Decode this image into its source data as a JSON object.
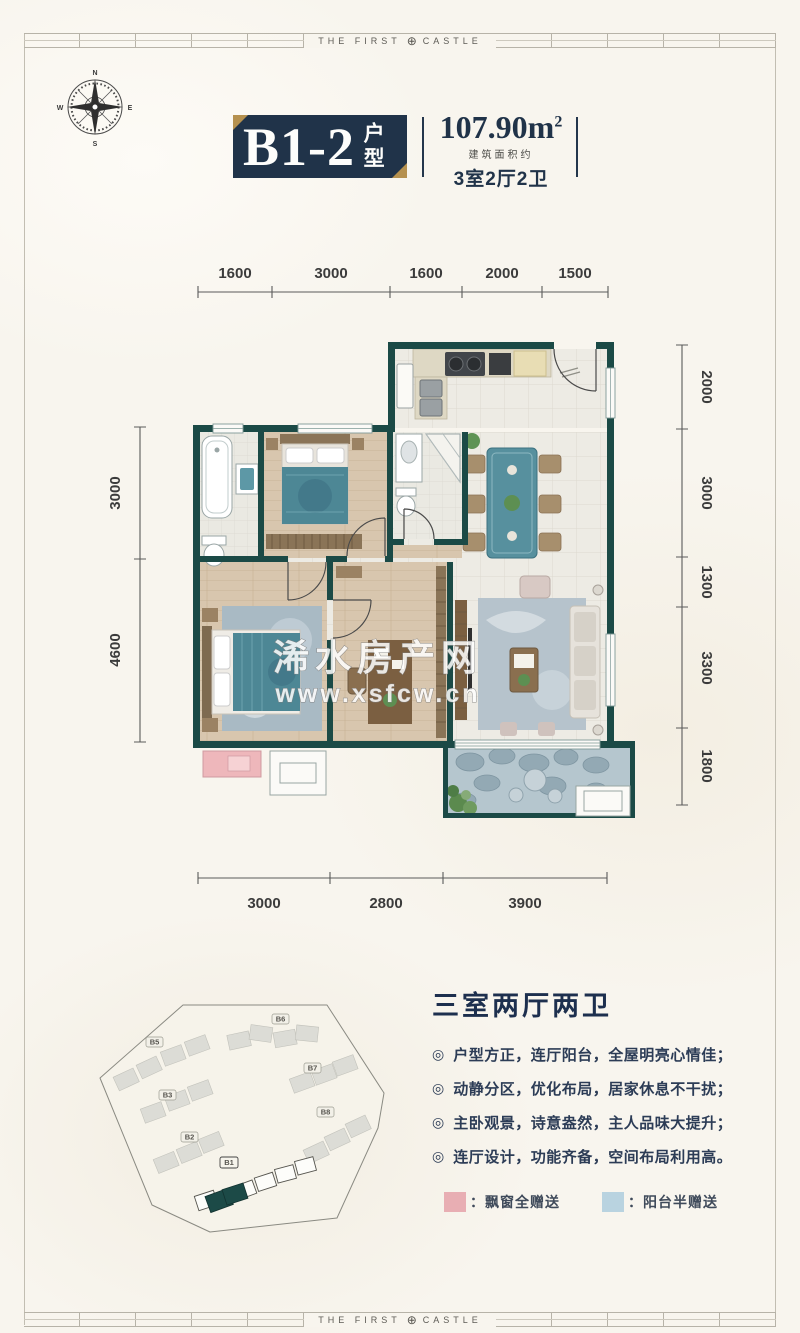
{
  "brand": {
    "left": "THE FIRST",
    "logo": "⊕",
    "right": "CASTLE"
  },
  "compass": {
    "n": "N",
    "e": "E",
    "s": "S",
    "w": "W"
  },
  "header": {
    "unit_code": "B1-2",
    "unit_suffix": "户型",
    "area_value": "107.90m",
    "area_sup": "2",
    "area_note": "建筑面积约",
    "rooms": "3室2厅2卫"
  },
  "floorplan": {
    "dims_top": [
      "1600",
      "3000",
      "1600",
      "2000",
      "1500"
    ],
    "dims_right": [
      "2000",
      "3000",
      "1300",
      "3300",
      "1800"
    ],
    "dims_left": [
      "3000",
      "4600"
    ],
    "dims_bottom": [
      "3000",
      "2800",
      "3900"
    ],
    "watermark": {
      "line1": "浠水房产网",
      "line2": "www.xsfcw.cn"
    }
  },
  "siteplan": {
    "labels": [
      "B5",
      "B6",
      "B3",
      "B7",
      "B8",
      "B2",
      "B1"
    ],
    "highlighted": "B1"
  },
  "features": {
    "heading": "三室两厅两卫",
    "bullet": "◎",
    "items": [
      "户型方正，连厅阳台，全屋明亮心情佳；",
      "动静分区，优化布局，居家休息不干扰；",
      "主卧观景，诗意盎然，主人品味大提升；",
      "连厅设计，功能齐备，空间布局利用高。"
    ]
  },
  "legend": {
    "items": [
      {
        "label": "：飘窗全赠送",
        "color": "#e8aeb3"
      },
      {
        "label": "：阳台半赠送",
        "color": "#b9d3e0"
      }
    ]
  },
  "colors": {
    "wall": "#1b4a46",
    "navy": "#203349",
    "gold": "#b5914f"
  }
}
